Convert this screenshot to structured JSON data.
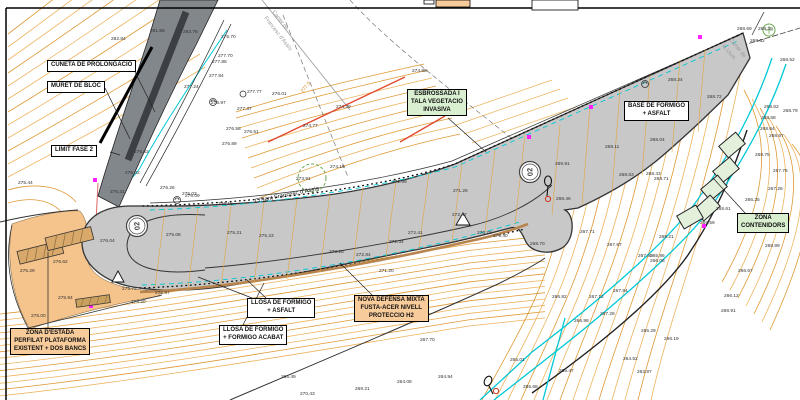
{
  "labels": {
    "cuneta": "CUNETA DE PROLONGACIO",
    "muret": "MURET DE BLOC",
    "limit": "LIMIT FASE 2",
    "esb1": "ESBROSSADA I",
    "esb2": "TALA VEGETACIO",
    "esb3": "INVASIVA",
    "base1": "BASE DE FORMIGO",
    "base2": "+ ASFALT",
    "cont1": "ZONA",
    "cont2": "CONTENIDORS",
    "estada1": "ZONA D'ESTADA",
    "estada2": "PERFILAT PLATAFORMA",
    "estada3": "EXISTENT + DOS BANCS",
    "llosa_a1": "LLOSA DE FORMIGO",
    "llosa_a2": "+ ASFALT",
    "llosa_b1": "LLOSA DE FORMIGO",
    "llosa_b2": "+ FORMIGO ACABAT",
    "nova1": "NOVA DEFENSA MIXTA",
    "nova2": "FUSTA-ACER NIVELL",
    "nova3": "PROTECCIO H2"
  },
  "streets": {
    "main": "C/Sant Francesc d'Assís",
    "tl1": "Carrer de",
    "tl2": "Francesc d'Assís",
    "tr1": "Carrer de",
    "tr2": "la Llum"
  },
  "section_markers": [
    "02",
    "02"
  ],
  "contour_labels": [
    {
      "x": 303,
      "y": 93,
      "t": "277.5",
      "r": -52
    }
  ],
  "elevations": [
    [
      111,
      40,
      "282.84"
    ],
    [
      150,
      32,
      "281.66"
    ],
    [
      183,
      33,
      "283.76"
    ],
    [
      221,
      38,
      "275.70"
    ],
    [
      218,
      57,
      "277.70"
    ],
    [
      212,
      63,
      "277.88"
    ],
    [
      209,
      77,
      "277.84"
    ],
    [
      184,
      88,
      "277.24"
    ],
    [
      211,
      104,
      "276.97"
    ],
    [
      247,
      93,
      "277.77"
    ],
    [
      237,
      110,
      "277.37"
    ],
    [
      272,
      95,
      "276.01"
    ],
    [
      226,
      130,
      "276.58"
    ],
    [
      244,
      133,
      "276.51"
    ],
    [
      222,
      145,
      "276.89"
    ],
    [
      134,
      153,
      "276.63"
    ],
    [
      18,
      184,
      "275.44"
    ],
    [
      125,
      174,
      "276.32"
    ],
    [
      110,
      193,
      "276.31"
    ],
    [
      182,
      195,
      "275.03"
    ],
    [
      412,
      72,
      "274.88"
    ],
    [
      336,
      108,
      "274.39"
    ],
    [
      303,
      127,
      "274.77"
    ],
    [
      330,
      168,
      "274.19"
    ],
    [
      296,
      180,
      "273.91"
    ],
    [
      392,
      183,
      "272.99"
    ],
    [
      453,
      192,
      "271.26"
    ],
    [
      555,
      165,
      "269.91"
    ],
    [
      605,
      148,
      "269.11"
    ],
    [
      646,
      175,
      "268.43"
    ],
    [
      556,
      200,
      "268.46"
    ],
    [
      530,
      245,
      "268.70"
    ],
    [
      477,
      234,
      "270.73"
    ],
    [
      493,
      237,
      "270.40"
    ],
    [
      452,
      216,
      "272.47"
    ],
    [
      408,
      234,
      "272.41"
    ],
    [
      389,
      243,
      "272.34"
    ],
    [
      329,
      253,
      "273.26"
    ],
    [
      356,
      256,
      "272.84"
    ],
    [
      379,
      272,
      "271.20"
    ],
    [
      737,
      30,
      "268.69"
    ],
    [
      758,
      30,
      "268.39"
    ],
    [
      750,
      42,
      "268.62"
    ],
    [
      668,
      81,
      "268.24"
    ],
    [
      707,
      98,
      "268.72"
    ],
    [
      780,
      61,
      "268.52"
    ],
    [
      783,
      112,
      "268.79"
    ],
    [
      764,
      108,
      "268.62"
    ],
    [
      761,
      119,
      "268.68"
    ],
    [
      760,
      130,
      "268.64"
    ],
    [
      769,
      137,
      "268.67"
    ],
    [
      650,
      141,
      "268.04"
    ],
    [
      654,
      180,
      "268.71"
    ],
    [
      619,
      176,
      "268.63"
    ],
    [
      755,
      156,
      "268.75"
    ],
    [
      773,
      172,
      "267.76"
    ],
    [
      768,
      190,
      "267.26"
    ],
    [
      745,
      201,
      "266.25"
    ],
    [
      716,
      210,
      "268.61"
    ],
    [
      700,
      224,
      "268.59"
    ],
    [
      659,
      238,
      "268.21"
    ],
    [
      650,
      257,
      "265.86"
    ],
    [
      765,
      247,
      "268.99"
    ],
    [
      580,
      233,
      "267.71"
    ],
    [
      607,
      246,
      "267.87"
    ],
    [
      638,
      257,
      "267.90"
    ],
    [
      650,
      262,
      "266.06"
    ],
    [
      613,
      292,
      "267.84"
    ],
    [
      589,
      298,
      "267.12"
    ],
    [
      600,
      315,
      "267.28"
    ],
    [
      552,
      298,
      "266.82"
    ],
    [
      574,
      322,
      "266.98"
    ],
    [
      724,
      297,
      "266.12"
    ],
    [
      721,
      312,
      "268.91"
    ],
    [
      738,
      272,
      "266.67"
    ],
    [
      641,
      332,
      "265.29"
    ],
    [
      664,
      340,
      "266.19"
    ],
    [
      623,
      360,
      "264.52"
    ],
    [
      637,
      373,
      "263.97"
    ],
    [
      438,
      378,
      "264.94"
    ],
    [
      510,
      361,
      "265.01"
    ],
    [
      397,
      383,
      "264.08"
    ],
    [
      559,
      372,
      "265.47"
    ],
    [
      420,
      341,
      "267.70"
    ],
    [
      300,
      395,
      "270.43"
    ],
    [
      355,
      390,
      "269.21"
    ],
    [
      523,
      388,
      "265.68"
    ],
    [
      281,
      378,
      "265.49"
    ],
    [
      100,
      242,
      "276.04"
    ],
    [
      166,
      236,
      "275.08"
    ],
    [
      227,
      234,
      "275.21"
    ],
    [
      259,
      237,
      "275.23"
    ],
    [
      53,
      263,
      "276.62"
    ],
    [
      20,
      272,
      "275.29"
    ],
    [
      58,
      299,
      "275.94"
    ],
    [
      122,
      290,
      "275.72"
    ],
    [
      155,
      294,
      "275.87"
    ],
    [
      131,
      303,
      "275.20"
    ],
    [
      31,
      317,
      "275.00"
    ],
    [
      160,
      189,
      "276.26"
    ],
    [
      185,
      197,
      "276.09"
    ],
    [
      218,
      205,
      "276.18"
    ]
  ],
  "colors": {
    "contour": "#de9934",
    "contour_light": "#eeb25c",
    "water": "#00c8d7",
    "road_fill": "#c8c8c8",
    "old_road": "#82878c",
    "zone_fill": "#f5c38c",
    "green_fill": "#d9efd0",
    "orange_label": "#f8cb9b",
    "barrier": "#b9854e",
    "magenta": "#ff1fff",
    "red": "#e04a2f",
    "green_line": "#6aa84f"
  }
}
